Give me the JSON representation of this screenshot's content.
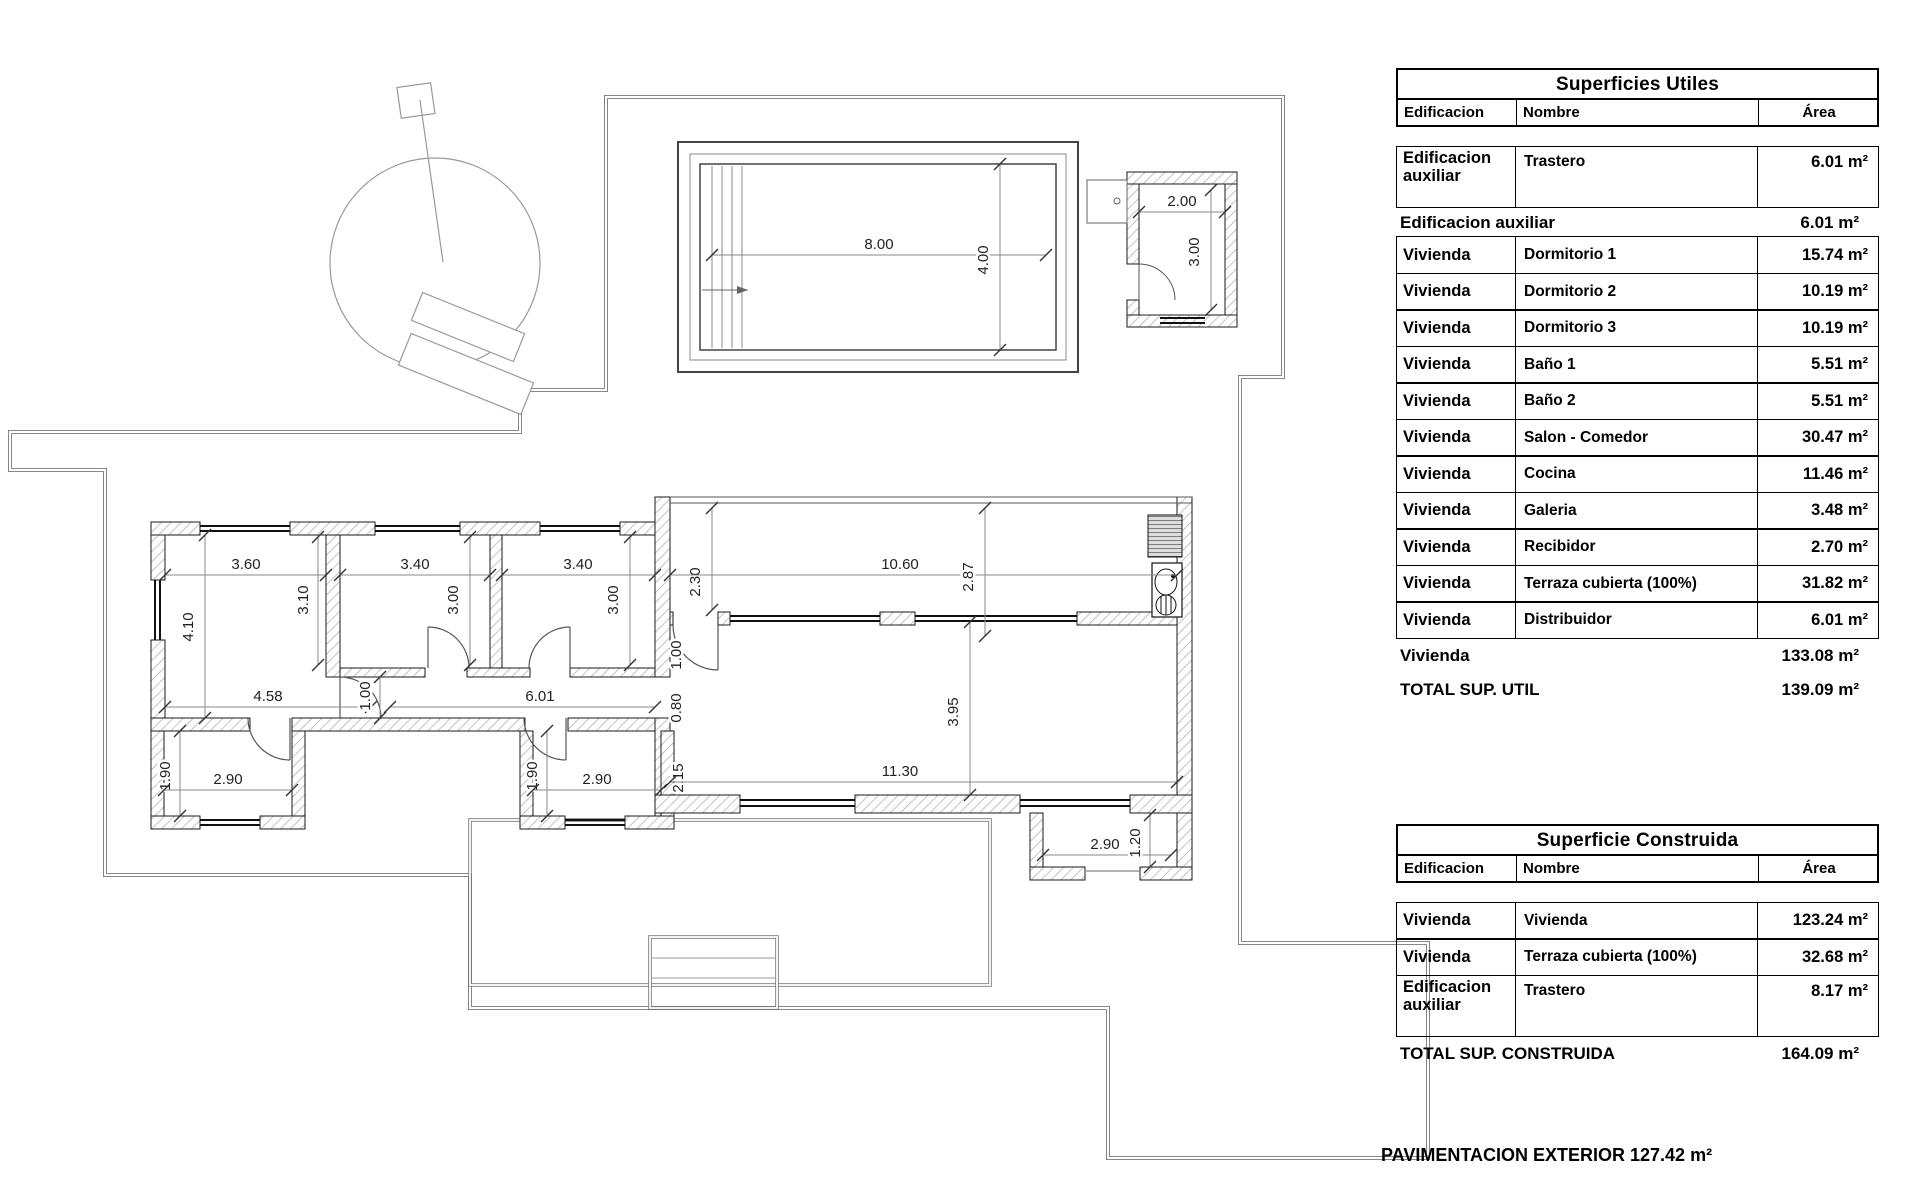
{
  "plan": {
    "dim_labels": [
      {
        "t": "3.60",
        "x": 246,
        "y": 569,
        "l": [
          165,
          575,
          326,
          575
        ]
      },
      {
        "t": "3.40",
        "x": 415,
        "y": 569,
        "l": [
          340,
          575,
          490,
          575
        ]
      },
      {
        "t": "3.40",
        "x": 578,
        "y": 569,
        "l": [
          502,
          575,
          655,
          575
        ]
      },
      {
        "t": "4.10",
        "x": 193,
        "y": 627,
        "r": 1,
        "l": [
          205,
          535,
          205,
          718
        ]
      },
      {
        "t": "3.10",
        "x": 308,
        "y": 600,
        "r": 1,
        "l": [
          318,
          537,
          318,
          665
        ]
      },
      {
        "t": "3.00",
        "x": 458,
        "y": 600,
        "r": 1,
        "l": [
          470,
          537,
          470,
          665
        ]
      },
      {
        "t": "3.00",
        "x": 618,
        "y": 600,
        "r": 1,
        "l": [
          630,
          537,
          630,
          665
        ]
      },
      {
        "t": "2.30",
        "x": 700,
        "y": 582,
        "r": 1,
        "l": [
          712,
          508,
          712,
          610
        ]
      },
      {
        "t": "10.60",
        "x": 900,
        "y": 569,
        "l": [
          670,
          575,
          1177,
          575
        ]
      },
      {
        "t": "2.87",
        "x": 973,
        "y": 577,
        "r": 1,
        "l": [
          985,
          508,
          985,
          636
        ]
      },
      {
        "t": "4.58",
        "x": 268,
        "y": 701,
        "l": [
          165,
          707,
          371,
          707
        ]
      },
      {
        "t": "1.00",
        "x": 370,
        "y": 696,
        "r": 1,
        "l": [
          380,
          677,
          380,
          718
        ]
      },
      {
        "t": "6.01",
        "x": 540,
        "y": 701,
        "l": [
          390,
          707,
          655,
          707
        ]
      },
      {
        "t": "1.00",
        "x": 681,
        "y": 655,
        "r": 1
      },
      {
        "t": "0.80",
        "x": 681,
        "y": 708,
        "r": 1
      },
      {
        "t": "2.15",
        "x": 683,
        "y": 778,
        "r": 1
      },
      {
        "t": "3.95",
        "x": 958,
        "y": 712,
        "r": 1,
        "l": [
          970,
          622,
          970,
          795
        ]
      },
      {
        "t": "11.30",
        "x": 900,
        "y": 776,
        "l": [
          670,
          782,
          1177,
          782
        ]
      },
      {
        "t": "1.90",
        "x": 170,
        "y": 776,
        "r": 1,
        "l": [
          180,
          731,
          180,
          816
        ]
      },
      {
        "t": "2.90",
        "x": 228,
        "y": 784,
        "l": [
          164,
          790,
          292,
          790
        ]
      },
      {
        "t": "1.90",
        "x": 537,
        "y": 776,
        "r": 1,
        "l": [
          547,
          731,
          547,
          816
        ]
      },
      {
        "t": "2.90",
        "x": 597,
        "y": 784,
        "l": [
          533,
          790,
          661,
          790
        ]
      },
      {
        "t": "2.90",
        "x": 1105,
        "y": 849,
        "l": [
          1043,
          855,
          1171,
          855
        ]
      },
      {
        "t": "1.20",
        "x": 1140,
        "y": 843,
        "r": 1,
        "l": [
          1150,
          815,
          1150,
          867
        ]
      },
      {
        "t": "2.00",
        "x": 1182,
        "y": 206,
        "l": [
          1139,
          212,
          1225,
          212
        ]
      },
      {
        "t": "3.00",
        "x": 1199,
        "y": 252,
        "r": 1,
        "l": [
          1211,
          190,
          1211,
          310
        ]
      },
      {
        "t": "8.00",
        "x": 879,
        "y": 249,
        "l": [
          712,
          255,
          1046,
          255
        ]
      },
      {
        "t": "4.00",
        "x": 988,
        "y": 260,
        "r": 1,
        "l": [
          1000,
          164,
          1000,
          350
        ]
      }
    ]
  },
  "tables": {
    "utiles": {
      "title": "Superficies Utiles",
      "headers": [
        "Edificacion",
        "Nombre",
        "Área"
      ],
      "rows": [
        {
          "type": "data",
          "tall": true,
          "e": "Edificacion auxiliar",
          "n": "Trastero",
          "a": "6.01 m²"
        },
        {
          "type": "subtotal",
          "label": "Edificacion auxiliar",
          "value": "6.01 m²"
        },
        {
          "type": "data",
          "e": "Vivienda",
          "n": "Dormitorio 1",
          "a": "15.74 m²"
        },
        {
          "type": "data",
          "e": "Vivienda",
          "n": "Dormitorio 2",
          "a": "10.19 m²"
        },
        {
          "type": "data",
          "e": "Vivienda",
          "n": "Dormitorio 3",
          "a": "10.19 m²"
        },
        {
          "type": "data",
          "e": "Vivienda",
          "n": "Baño 1",
          "a": "5.51 m²"
        },
        {
          "type": "data",
          "e": "Vivienda",
          "n": "Baño 2",
          "a": "5.51 m²"
        },
        {
          "type": "data",
          "e": "Vivienda",
          "n": "Salon - Comedor",
          "a": "30.47 m²"
        },
        {
          "type": "data",
          "e": "Vivienda",
          "n": "Cocina",
          "a": "11.46 m²"
        },
        {
          "type": "data",
          "e": "Vivienda",
          "n": "Galeria",
          "a": "3.48 m²"
        },
        {
          "type": "data",
          "e": "Vivienda",
          "n": "Recibidor",
          "a": "2.70 m²"
        },
        {
          "type": "data",
          "e": "Vivienda",
          "n": "Terraza cubierta (100%)",
          "a": "31.82 m²"
        },
        {
          "type": "data",
          "e": "Vivienda",
          "n": "Distribuidor",
          "a": "6.01 m²"
        },
        {
          "type": "subtotal",
          "big": true,
          "label": "Vivienda",
          "value": "133.08 m²"
        },
        {
          "type": "subtotal",
          "big": true,
          "label": "TOTAL SUP. UTIL",
          "value": "139.09 m²"
        }
      ]
    },
    "construida": {
      "title": "Superficie Construida",
      "headers": [
        "Edificacion",
        "Nombre",
        "Área"
      ],
      "rows": [
        {
          "type": "data",
          "e": "Vivienda",
          "n": "Vivienda",
          "a": "123.24 m²"
        },
        {
          "type": "data",
          "e": "Vivienda",
          "n": "Terraza cubierta (100%)",
          "a": "32.68 m²"
        },
        {
          "type": "data",
          "tall": true,
          "e": "Edificacion auxiliar",
          "n": "Trastero",
          "a": "8.17 m²"
        },
        {
          "type": "subtotal",
          "big": true,
          "label": "TOTAL SUP. CONSTRUIDA",
          "value": "164.09 m²"
        }
      ]
    }
  },
  "footer": {
    "pavimentacion": "PAVIMENTACION EXTERIOR 127.42 m²"
  },
  "colors": {
    "wall_hatch": "#b4b4b4",
    "wall_edge": "#1a1a1a",
    "boundary": "#777777",
    "dim_line": "#8a8a8a",
    "dim_text": "#222222",
    "thin_feature": "#999999"
  }
}
